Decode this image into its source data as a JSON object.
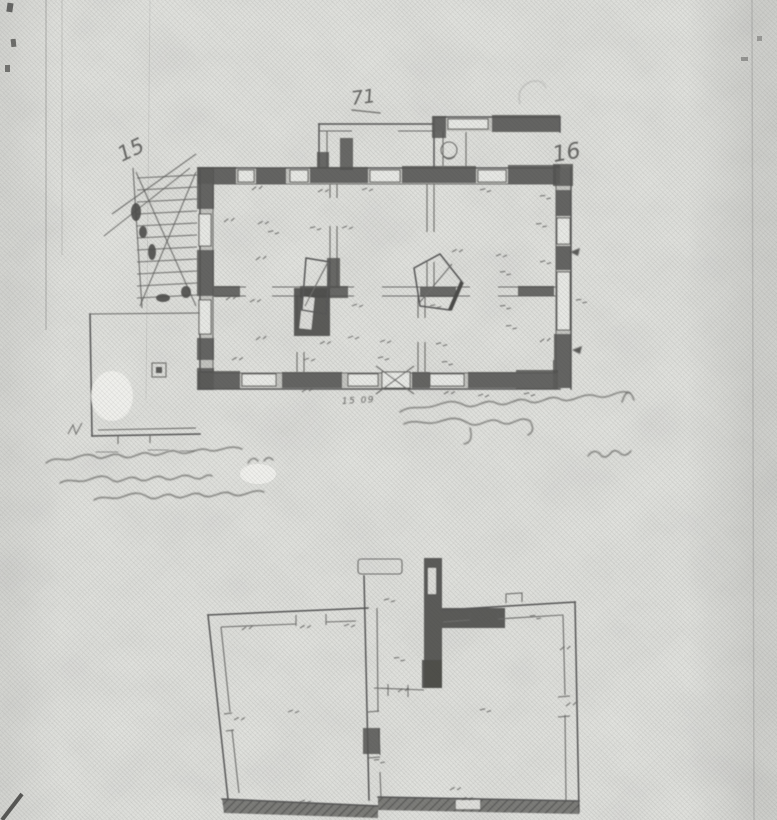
{
  "palette": {
    "paper": "#e6e7e3",
    "ink": "#4f4f4f"
  },
  "upper_plan": {
    "sheet_mark_left": "15",
    "sheet_mark_top": "71",
    "sheet_mark_right": "16",
    "door_dimension": "15 09"
  }
}
